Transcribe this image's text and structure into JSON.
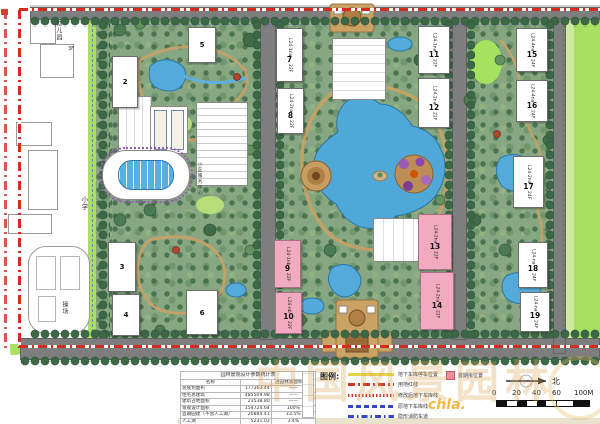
{
  "colors": {
    "pink_building": "#f2aac0",
    "water": "#4fa8d8",
    "road": "#7e7e7e",
    "boundary_red": "#d62b1f",
    "light_green": "#aadf62"
  },
  "site": {
    "labels": [
      {
        "id": "kindergarten",
        "text": "幼儿园",
        "x": 54,
        "y": 20,
        "vertical": true,
        "size": 6
      },
      {
        "id": "kindergarten-floors",
        "text": "3F",
        "x": 68,
        "y": 46,
        "vertical": false,
        "size": 5
      },
      {
        "id": "primary-school",
        "text": "小学",
        "x": 79,
        "y": 196,
        "vertical": true,
        "size": 6.5
      },
      {
        "id": "playground",
        "text": "操场",
        "x": 60,
        "y": 301,
        "vertical": true,
        "size": 6
      },
      {
        "id": "service-center",
        "text": "小区服务中心",
        "x": 196,
        "y": 162,
        "vertical": true,
        "size": 4.6
      }
    ],
    "buildings": [
      {
        "num": "2",
        "x": 112,
        "y": 56,
        "w": 26,
        "h": 52
      },
      {
        "num": "5",
        "x": 188,
        "y": 27,
        "w": 28,
        "h": 36
      },
      {
        "num": "3",
        "x": 108,
        "y": 242,
        "w": 28,
        "h": 50
      },
      {
        "num": "4",
        "x": 112,
        "y": 294,
        "w": 28,
        "h": 42
      },
      {
        "num": "6",
        "x": 186,
        "y": 290,
        "w": 32,
        "h": 45
      },
      {
        "num": "7",
        "code": "L24-1na",
        "floors": "22F",
        "x": 276,
        "y": 28,
        "w": 27,
        "h": 54
      },
      {
        "num": "8",
        "code": "L24-2na",
        "floors": "22F",
        "x": 277,
        "y": 88,
        "w": 27,
        "h": 46
      },
      {
        "num": "9",
        "code": "L24-1nb",
        "floors": "22F",
        "pink": true,
        "x": 274,
        "y": 240,
        "w": 27,
        "h": 48
      },
      {
        "num": "10",
        "code": "L24-nb",
        "floors": "22F",
        "pink": true,
        "x": 275,
        "y": 292,
        "w": 27,
        "h": 42
      },
      {
        "num": "11",
        "code": "L24-1na",
        "floors": "22F",
        "x": 418,
        "y": 26,
        "w": 32,
        "h": 48
      },
      {
        "num": "12",
        "code": "L24-2na",
        "floors": "22F",
        "x": 418,
        "y": 78,
        "w": 32,
        "h": 50
      },
      {
        "num": "13",
        "code": "L24-2na",
        "floors": "22F",
        "pink": true,
        "x": 418,
        "y": 214,
        "w": 34,
        "h": 56
      },
      {
        "num": "14",
        "code": "L24-2na",
        "floors": "22F",
        "pink": true,
        "x": 420,
        "y": 272,
        "w": 34,
        "h": 58
      },
      {
        "num": "15",
        "code": "L24-4na",
        "floors": "24F",
        "x": 516,
        "y": 28,
        "w": 32,
        "h": 44
      },
      {
        "num": "16",
        "code": "L24-4na",
        "floors": "24F",
        "x": 516,
        "y": 80,
        "w": 32,
        "h": 42
      },
      {
        "num": "17",
        "code": "L24-2nd",
        "floors": "24F",
        "x": 513,
        "y": 156,
        "w": 31,
        "h": 52
      },
      {
        "num": "18",
        "code": "L24-na",
        "floors": "24F",
        "x": 518,
        "y": 242,
        "w": 30,
        "h": 46
      },
      {
        "num": "19",
        "code": "L24-na",
        "floors": "24F",
        "x": 520,
        "y": 292,
        "w": 30,
        "h": 40
      }
    ]
  },
  "table": {
    "title": "园林景观设计参数统计表",
    "headers": {
      "name": "名称",
      "ratio": "占园林总面积比例"
    },
    "rows": [
      {
        "name": "总规划面积",
        "value": "177363.44",
        "ratio": "——"
      },
      {
        "name": "住宅总建筑",
        "value": "485509.98",
        "ratio": "——"
      },
      {
        "name": "建筑占地面积",
        "value": "23538.80",
        "ratio": "——"
      },
      {
        "name": "景观设计面积",
        "value": "154724.64",
        "ratio": "100%"
      },
      {
        "name": "首期园建（不含人工湖）",
        "value": "20884.41",
        "ratio": "13.5%"
      },
      {
        "name": "人工湖",
        "value": "5231.03",
        "ratio": "3.4%"
      },
      {
        "name": "绿化",
        "value": "128540.03",
        "ratio": "83.1%"
      }
    ]
  },
  "legend": {
    "heading": "图例:",
    "items": [
      {
        "symbol": "underground-garage-parking-line",
        "style": "sym-yellow-solid",
        "label": "地下车库停车位置"
      },
      {
        "symbol": "land-red-line",
        "style": "sym-red-dashdot",
        "label": "用地红线"
      },
      {
        "symbol": "revised-basement-line",
        "style": "sym-red-dotted",
        "label": "修改后地下车库线"
      },
      {
        "symbol": "original-garage-line",
        "style": "sym-blue-dashed",
        "label": "原地下车库线"
      },
      {
        "symbol": "hidden-fire-lane",
        "style": "sym-blue-dashdot",
        "label": "隐形消防车道"
      }
    ],
    "extra": {
      "symbol": "phase1-building-swatch",
      "style": "sym-pink-square",
      "label": "首期房位置"
    }
  },
  "north": {
    "label": "北"
  },
  "scalebar": {
    "ticks": [
      "0",
      "20",
      "40",
      "60"
    ],
    "end": "100M"
  },
  "watermark": {
    "cn": "中国风景园林网",
    "en": "chla."
  }
}
